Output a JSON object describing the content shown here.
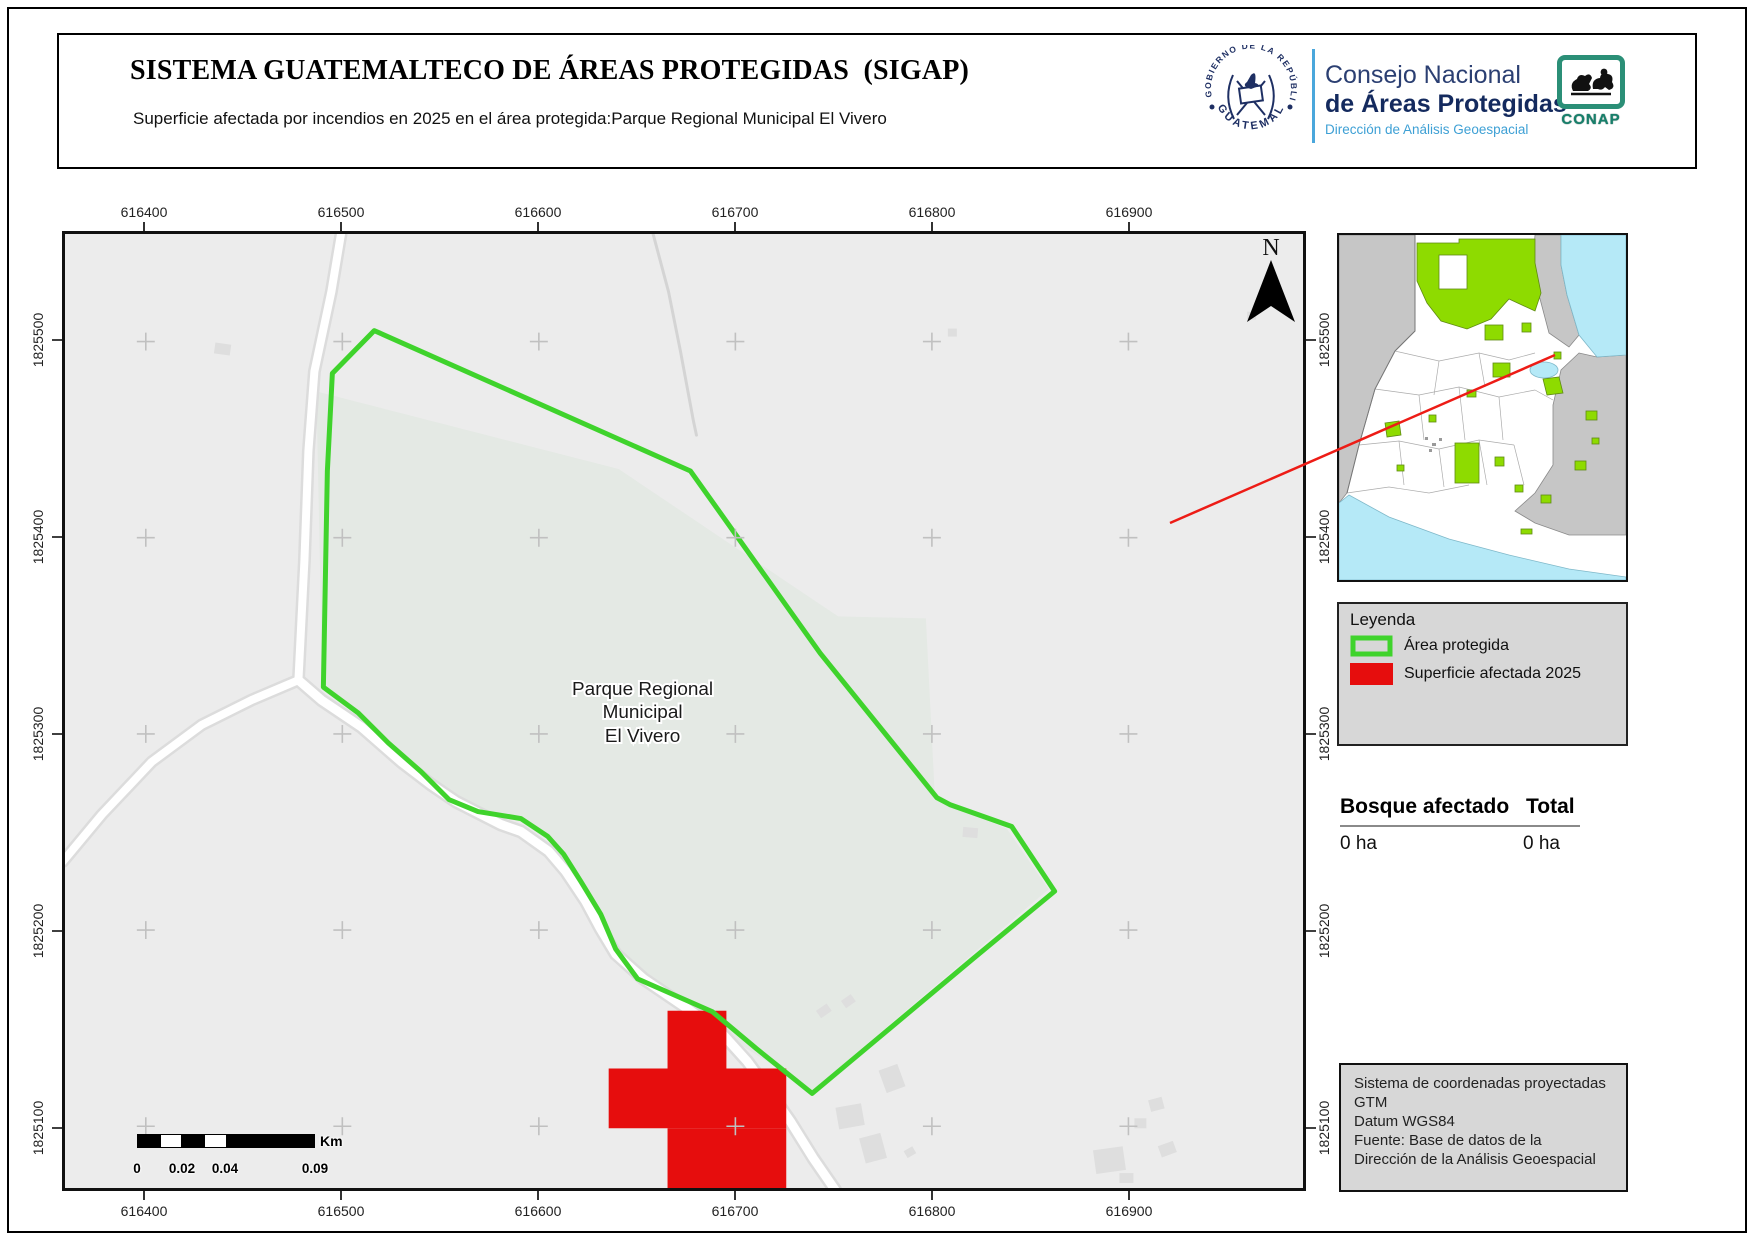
{
  "header": {
    "title": "SISTEMA GUATEMALTECO DE ÁREAS PROTEGIDAS  (SIGAP)",
    "subtitle": "Superficie afectada por incendios en 2025 en el área protegida:Parque Regional Municipal El Vivero"
  },
  "logos": {
    "government": {
      "arc_text": "GOBIERNO DE LA REPÚBLICA",
      "bottom_text": "GUATEMALA"
    },
    "conap": {
      "line1": "Consejo Nacional",
      "line2": "de Áreas Protegidas",
      "line3": "Dirección de Análisis Geoespacial",
      "badge": "CONAP"
    }
  },
  "map": {
    "place_label": {
      "line1": "Parque Regional",
      "line2": "Municipal",
      "line3": "El Vivero"
    },
    "north_label": "N",
    "axes": {
      "x_labels": [
        "616400",
        "616500",
        "616600",
        "616700",
        "616800",
        "616900"
      ],
      "y_labels": [
        "1825500",
        "1825400",
        "1825300",
        "1825200",
        "1825100"
      ]
    },
    "scalebar": {
      "unit": "Km",
      "labels": [
        "0",
        "0.02",
        "0.04",
        "0.09"
      ]
    }
  },
  "legend": {
    "title": "Leyenda",
    "items": [
      {
        "label": "Área protegida"
      },
      {
        "label": "Superficie afectada 2025"
      }
    ]
  },
  "stats": {
    "col1_header": "Bosque afectado",
    "col2_header": "Total",
    "col1_value": "0 ha",
    "col2_value": "0 ha"
  },
  "info_box": {
    "lines": [
      "Sistema de coordenadas proyectadas",
      "GTM",
      "Datum WGS84",
      "Fuente: Base de datos de la",
      "Dirección de la Análisis Geoespacial"
    ]
  },
  "colors": {
    "protected_outline": "#3fd32c",
    "affected_fill": "#e60d0d",
    "protected_inset_fill": "#8edb00",
    "water": "#b5e9f7",
    "neighbor_gray": "#c6c6c6",
    "connector_red": "#ed1c16"
  }
}
